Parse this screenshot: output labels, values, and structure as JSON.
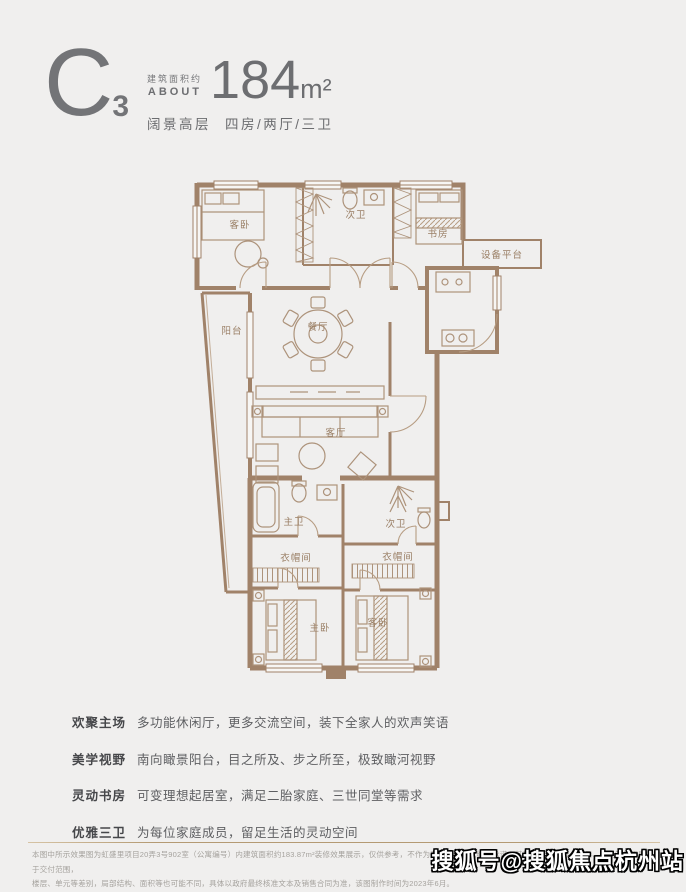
{
  "header": {
    "unit_letter": "C",
    "unit_number": "3",
    "area_label_cn": "建筑面积约",
    "area_label_en": "ABOUT",
    "area_value": "184",
    "area_unit": "m²",
    "subtitle_type": "阔景高层",
    "subtitle_layout": "四房/两厅/三卫"
  },
  "floorplan": {
    "wall_color": "#a08269",
    "line_color": "#ad937b",
    "label_color": "#997e64",
    "rooms": [
      {
        "id": "guest-bedroom-top",
        "label": "客卧"
      },
      {
        "id": "bath-top",
        "label": "次卫"
      },
      {
        "id": "study",
        "label": "书房"
      },
      {
        "id": "equipment-platform",
        "label": "设备平台"
      },
      {
        "id": "balcony",
        "label": "阳台"
      },
      {
        "id": "dining-room",
        "label": "餐厅"
      },
      {
        "id": "living-room",
        "label": "客厅"
      },
      {
        "id": "master-bath",
        "label": "主卫"
      },
      {
        "id": "closet-left",
        "label": "衣帽间"
      },
      {
        "id": "master-bedroom",
        "label": "主卧"
      },
      {
        "id": "bath-lower",
        "label": "次卫"
      },
      {
        "id": "closet-right",
        "label": "衣帽间"
      },
      {
        "id": "guest-bedroom-lower",
        "label": "客卧"
      }
    ]
  },
  "features": [
    {
      "title": "欢聚主场",
      "desc": "多功能休闲厅，更多交流空间，装下全家人的欢声笑语"
    },
    {
      "title": "美学视野",
      "desc": "南向瞰景阳台，目之所及、步之所至，极致瞰河视野"
    },
    {
      "title": "灵动书房",
      "desc": "可变理想起居室，满足二胎家庭、三世同堂等需求"
    },
    {
      "title": "优雅三卫",
      "desc": "为每位家庭成员，留足生活的灵动空间"
    }
  ],
  "disclaimer": {
    "line1": "本图中所示效果图为虹盛里项目20弄3号902室（公寓编号）内建筑面积约183.87m²装修效果展示，仅供参考，不作为要约的内容或继续承诺，其部分装修装饰、家具、陈设等均不属于交付范围，",
    "line2": "楼层、单元等差别，局部结构、面积等也可能不同，具体以政府最终核准文本及销售合同为准，该图制作时间为2023年6月。"
  },
  "watermark": "搜狐号@搜狐焦点杭州站"
}
